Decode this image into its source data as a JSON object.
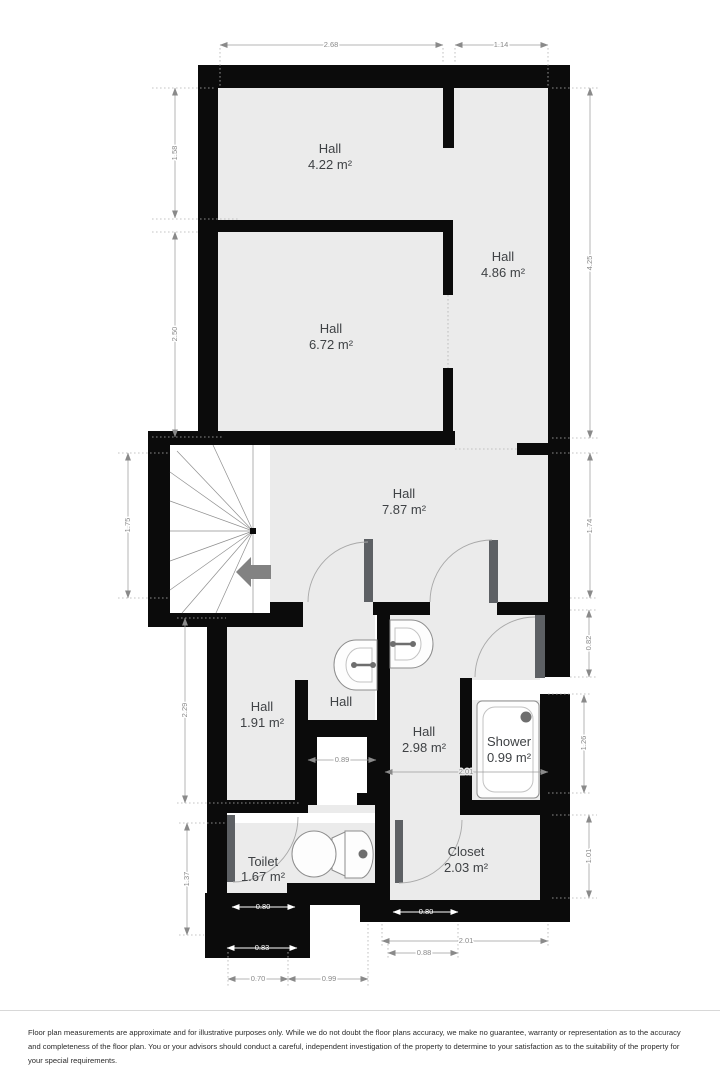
{
  "plan": {
    "rooms": [
      {
        "name": "Hall",
        "area": "4.22 m²"
      },
      {
        "name": "Hall",
        "area": "4.86 m²"
      },
      {
        "name": "Hall",
        "area": "6.72 m²"
      },
      {
        "name": "Hall",
        "area": "7.87 m²"
      },
      {
        "name": "Hall",
        "area": "1.91 m²"
      },
      {
        "name": "Hall"
      },
      {
        "name": "Hall",
        "area": "2.98 m²"
      },
      {
        "name": "Shower",
        "area": "0.99 m²"
      },
      {
        "name": "Toilet",
        "area": "1.67 m²"
      },
      {
        "name": "Closet",
        "area": "2.03 m²"
      }
    ],
    "dimensions": {
      "top": [
        "2.68",
        "1.14"
      ],
      "left": [
        "1.58",
        "2.50",
        "1.75",
        "2.29",
        "1.37"
      ],
      "right": [
        "4.25",
        "1.74",
        "0.82",
        "1.26",
        "1.01"
      ],
      "inner": [
        "0.89",
        "2.01",
        "0.80",
        "0.83",
        "0.80"
      ],
      "bottom": [
        "2.01",
        "0.88",
        "0.70",
        "0.99"
      ]
    },
    "fixtures": [
      "stairs",
      "direction-arrow-icon",
      "sink-icon",
      "sink-icon",
      "toilet-icon",
      "shower-tray-icon",
      "door-swing-icon"
    ],
    "colors": {
      "wall": "#0b0b0b",
      "floor": "#ebebeb",
      "background": "#ffffff",
      "dimension": "#8a8a8a",
      "room_label": "#3f4245",
      "door_leaf": "#5d6064",
      "fixture_outline": "#8d8d8d",
      "arrow": "#828282"
    }
  },
  "footer": {
    "disclaimer": "Floor plan measurements are approximate and for illustrative purposes only. While we do not doubt the floor plans accuracy, we make no guarantee, warranty or representation as to the accuracy and completeness of the floor plan. You or your advisors should conduct a careful, independent investigation of the property to determine to your satisfaction as to the suitability of the property for your special requirements."
  }
}
